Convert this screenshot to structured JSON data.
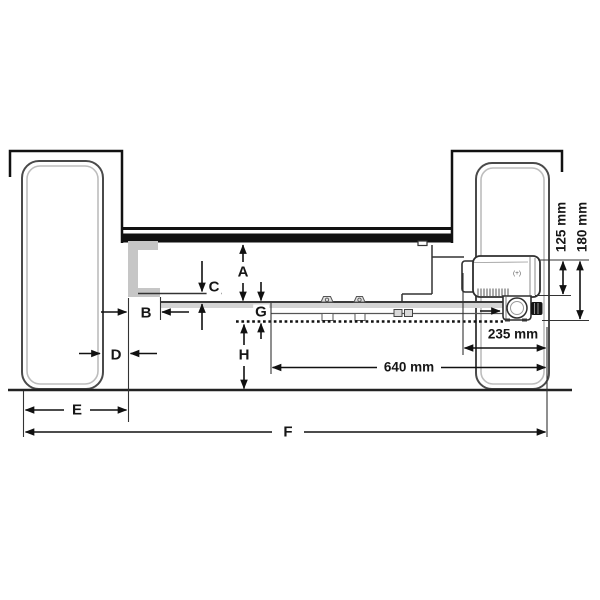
{
  "labels": {
    "A": "A",
    "B": "B",
    "C": "C",
    "D": "D",
    "E": "E",
    "F": "F",
    "G": "G",
    "H": "H"
  },
  "measurements": {
    "v125": "125 mm",
    "v180": "180 mm",
    "v235": "235 mm",
    "v640": "640 mm"
  },
  "motor_marking": "(+)",
  "colors": {
    "line": "#161616",
    "structure": "#111111",
    "bracket_gray": "#c6c6c6",
    "platform_gray": "#d4d4d4",
    "wheel_outline": "#4a4a4a",
    "wheel_inner": "#bdbdbd",
    "plug_black": "#141414"
  }
}
